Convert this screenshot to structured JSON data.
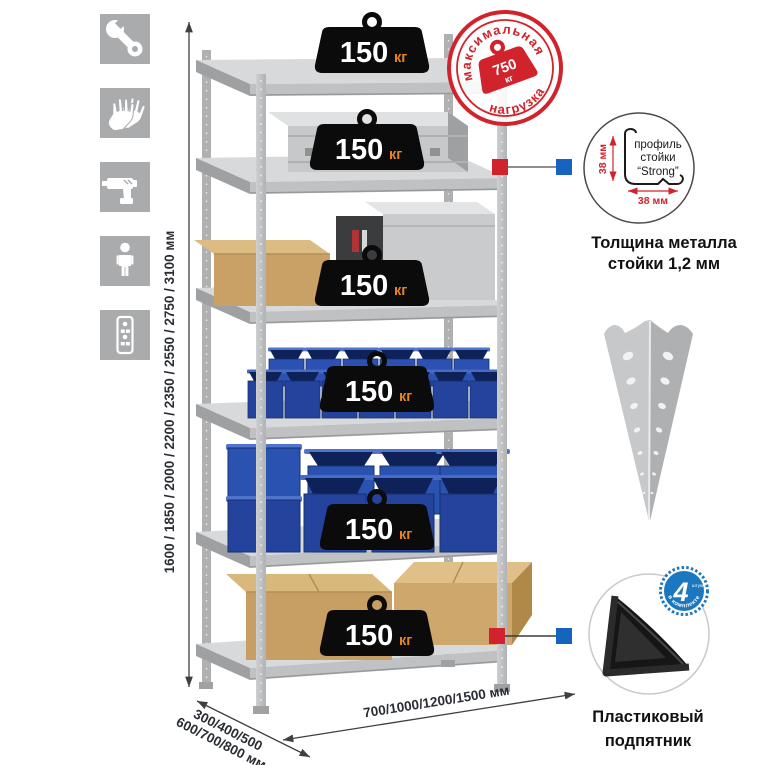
{
  "title": "Стеллаж металлический — схема нагрузок и размеров",
  "sidebar_icons": {
    "color": "#a9abac",
    "items": [
      {
        "name": "wrench-icon"
      },
      {
        "name": "gloves-icon"
      },
      {
        "name": "drill-icon"
      },
      {
        "name": "person-icon"
      },
      {
        "name": "rack-post-icon"
      }
    ]
  },
  "dimensions": {
    "height_label": "1600 / 1850 / 2000 / 2200 / 2350 / 2550 / 2750 / 3100 мм",
    "depth_label_line1": "300/400/500",
    "depth_label_line2": "600/700/800 мм",
    "width_label": "700/1000/1200/1500 мм"
  },
  "shelf_load": {
    "value": "150",
    "unit": "кг",
    "count": 6
  },
  "max_load_stamp": {
    "top_text": "максимальная",
    "bottom_text": "нагрузка",
    "value": "750",
    "unit": "кг"
  },
  "profile_callout": {
    "line1": "профиль",
    "line2": "стойки",
    "line3": "“Strong”",
    "vertical_dim": "38 мм",
    "horizontal_dim": "38 мм",
    "caption_line1": "Толщина металла",
    "caption_line2": "стойки 1,2 мм"
  },
  "foot_callout": {
    "badge_value": "4",
    "badge_small_text": "штуки",
    "badge_arc_text": "в комплекте",
    "caption_line1": "Пластиковый",
    "caption_line2": "подпятник"
  },
  "colors": {
    "accent_red": "#d1232c",
    "accent_blue": "#1565bf",
    "badge_blue": "#1b77c0",
    "weight_black": "#0b0b0b",
    "unit_orange": "#e8831f",
    "bin_blue": "#27479f",
    "cardboard": "#c79e63",
    "metal_light": "#d5d7d9",
    "icon_gray": "#a9abac"
  }
}
